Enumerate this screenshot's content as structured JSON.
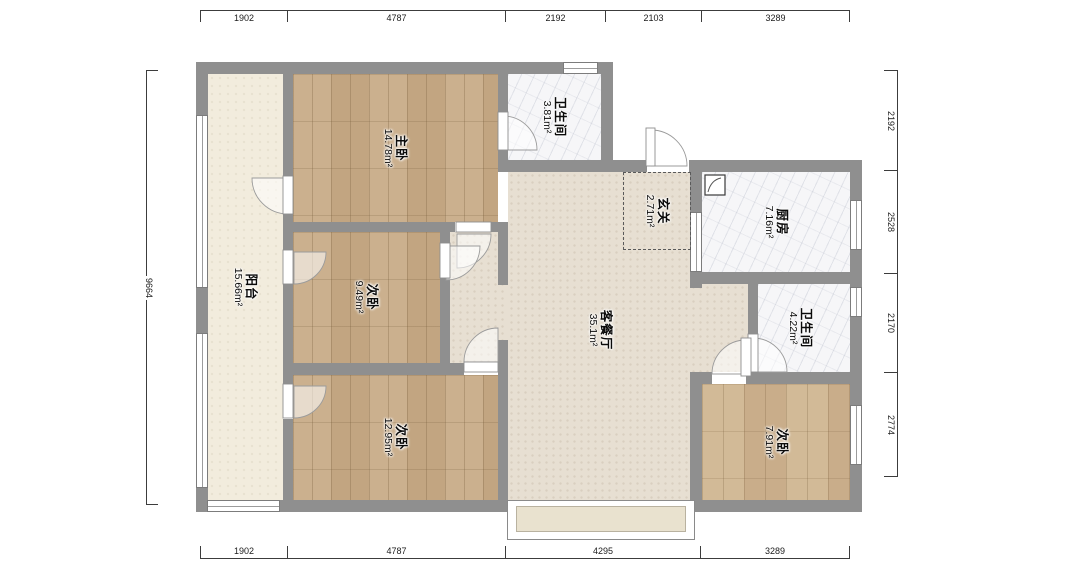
{
  "plan": {
    "type": "apartment-floor-plan",
    "rooms": [
      {
        "id": "balcony",
        "name": "阳台",
        "area": "15.66m²"
      },
      {
        "id": "master-bedroom",
        "name": "主卧",
        "area": "14.78m²"
      },
      {
        "id": "bathroom-top",
        "name": "卫生间",
        "area": "3.81m²"
      },
      {
        "id": "entry",
        "name": "玄关",
        "area": "2.71m²"
      },
      {
        "id": "kitchen",
        "name": "厨房",
        "area": "7.16m²"
      },
      {
        "id": "bedroom-mid",
        "name": "次卧",
        "area": "9.49m²"
      },
      {
        "id": "living-dining",
        "name": "客餐厅",
        "area": "35.1m²"
      },
      {
        "id": "bathroom-right",
        "name": "卫生间",
        "area": "4.22m²"
      },
      {
        "id": "bedroom-bottom",
        "name": "次卧",
        "area": "12.95m²"
      },
      {
        "id": "bedroom-right",
        "name": "次卧",
        "area": "7.91m²"
      }
    ],
    "dimensions": {
      "top": [
        "1902",
        "4787",
        "2192",
        "2103",
        "3289"
      ],
      "bottom": [
        "1902",
        "4787",
        "4295",
        "3289"
      ],
      "right": [
        "2192",
        "2528",
        "2170",
        "2774"
      ],
      "left": [
        "9664"
      ]
    },
    "colors": {
      "wall": "#8f8f8f",
      "wood_floor": "#c8ac8a",
      "tile_floor": "#e7dfd2",
      "balcony_floor": "#f2ecdd",
      "marble_floor": "#f6f6f8",
      "bay_window_fill": "#e9e2cf"
    }
  }
}
